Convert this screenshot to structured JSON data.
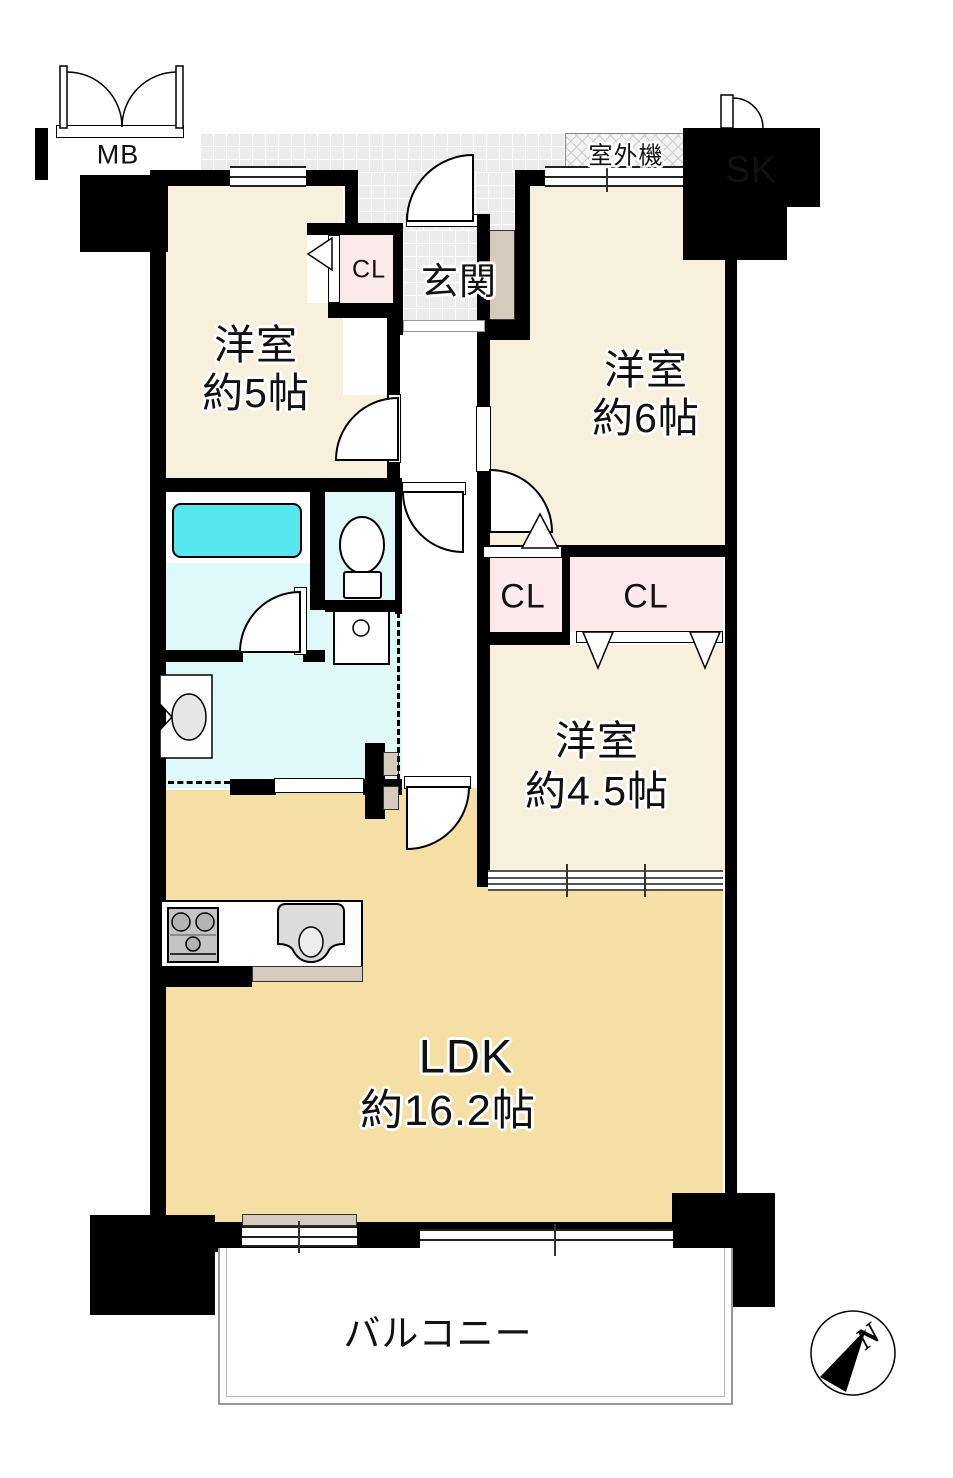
{
  "plan": {
    "type": "apartment-floor-plan",
    "labels": {
      "meter_box": "MB",
      "slop_sink": "SK",
      "outdoor_unit": "室外機",
      "entrance": "玄関",
      "closet_entrance": "CL",
      "closet_west": "CL",
      "closet_east": "CL",
      "balcony": "バルコニー",
      "north": "N"
    },
    "rooms": {
      "bedroom5": {
        "name": "洋室",
        "size": "約5帖"
      },
      "bedroom6": {
        "name": "洋室",
        "size": "約6帖"
      },
      "bedroom45": {
        "name": "洋室",
        "size": "約4.5帖"
      },
      "ldk": {
        "name": "LDK",
        "size": "約16.2帖"
      }
    },
    "colors": {
      "room_floor": "#F7F0DC",
      "ldk_floor": "#F5DFA5",
      "closet": "#FBE9EC",
      "wet_floor": "#DFF8F8",
      "bathtub": "#55E6EE",
      "corridor_tile": "#EBEBEB",
      "wood_trim": "#D5CBBD",
      "wall": "#000000"
    }
  }
}
